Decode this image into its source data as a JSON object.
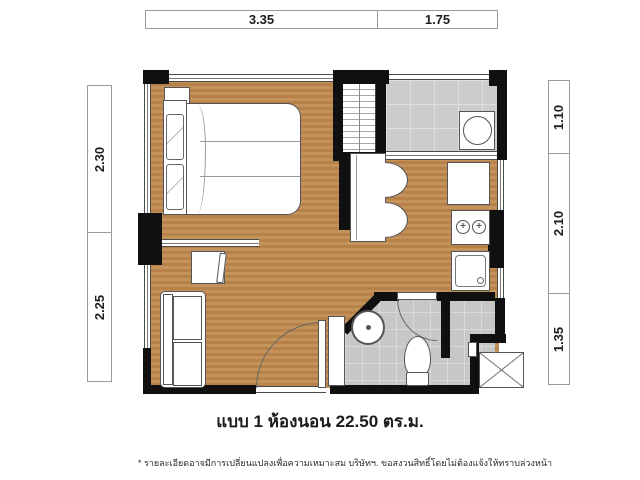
{
  "title": "แบบ 1 ห้องนอน 22.50 ตร.ม.",
  "footnote": "* รายละเอียดอาจมีการเปลี่ยนแปลงเพื่อความเหมาะสม บริษัทฯ. ขอสงวนสิทธิ์โดยไม่ต้องแจ้งให้ทราบล่วงหน้า",
  "dimensions": {
    "top": [
      {
        "label": "3.35"
      },
      {
        "label": "1.75"
      }
    ],
    "left": [
      {
        "label": "2.30"
      },
      {
        "label": "2.25"
      }
    ],
    "right": [
      {
        "label": "1.10"
      },
      {
        "label": "2.10"
      },
      {
        "label": "1.35"
      }
    ]
  },
  "colors": {
    "wall": "#101010",
    "wood_floor": "#bd8a52",
    "tile_gray": "#c7c7c6",
    "balcony_tile": "#cccccb",
    "line": "#555555"
  }
}
